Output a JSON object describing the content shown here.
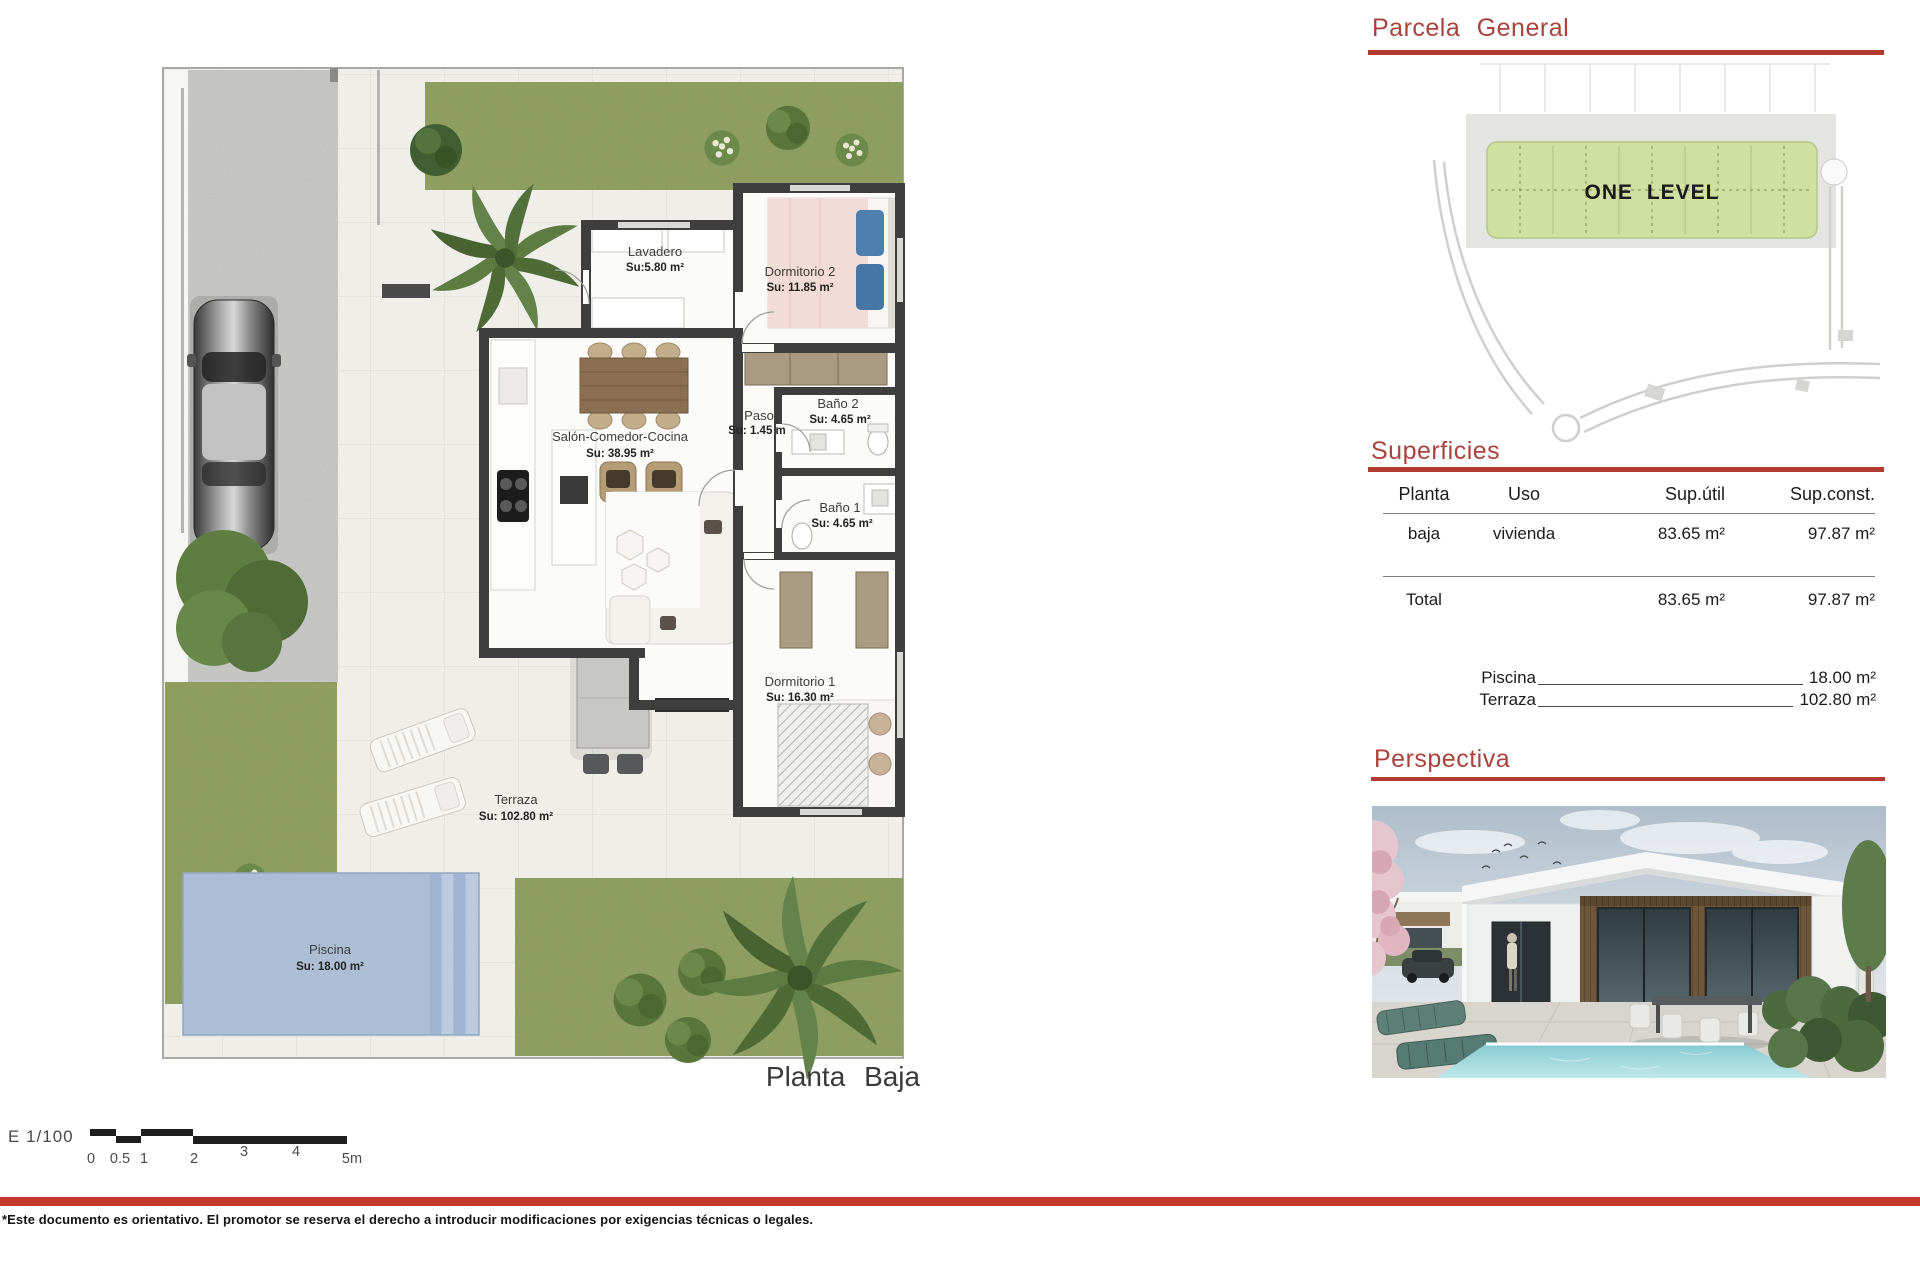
{
  "page": {
    "title_floor": "Planta Baja",
    "scale_label": "E 1/100",
    "scale_ticks": [
      "0",
      "0.5",
      "1",
      "2",
      "3",
      "4",
      "5m"
    ],
    "disclaimer": "*Este documento es orientativo. El promotor se reserva el derecho a introducir modificaciones por exigencias técnicas o legales."
  },
  "floor_plan": {
    "rooms": [
      {
        "name": "Lavadero",
        "area": "Su:5.80 m²"
      },
      {
        "name": "Dormitorio 2",
        "area": "Su: 11.85 m²"
      },
      {
        "name": "Baño 2",
        "area": "Su: 4.65 m²"
      },
      {
        "name": "Paso",
        "area": "Su: 1.45 m"
      },
      {
        "name": "Salón-Comedor-Cocina",
        "area": "Su: 38.95 m²"
      },
      {
        "name": "Baño 1",
        "area": "Su: 4.65 m²"
      },
      {
        "name": "Dormitorio 1",
        "area": "Su: 16.30 m²"
      },
      {
        "name": "Terraza",
        "area": "Su: 102.80 m²"
      },
      {
        "name": "Piscina",
        "area": "Su: 18.00 m²"
      }
    ]
  },
  "site_plan": {
    "heading": "Parcela General",
    "block_label": "ONE LEVEL"
  },
  "surfaces": {
    "heading": "Superficies",
    "columns": [
      "Planta",
      "Uso",
      "Sup.útil",
      "Sup.const."
    ],
    "row": {
      "planta": "baja",
      "uso": "vivienda",
      "sup_util": "83.65 m²",
      "sup_const": "97.87 m²"
    },
    "total_label": "Total",
    "total_util": "83.65 m²",
    "total_const": "97.87 m²",
    "extras": [
      {
        "label": "Piscina",
        "value": "18.00 m²"
      },
      {
        "label": "Terraza",
        "value": "102.80 m²"
      }
    ]
  },
  "perspective": {
    "heading": "Perspectiva"
  },
  "colors": {
    "accent_red": "#a8443d",
    "rule_red": "#b23a2e",
    "footer_bar": "#c33a2c",
    "garden_green": "#8f9e5e",
    "pool_blue": "#afc2db",
    "wall_dark": "#3e3e3e",
    "parcel_green": "#cfe0a0"
  }
}
